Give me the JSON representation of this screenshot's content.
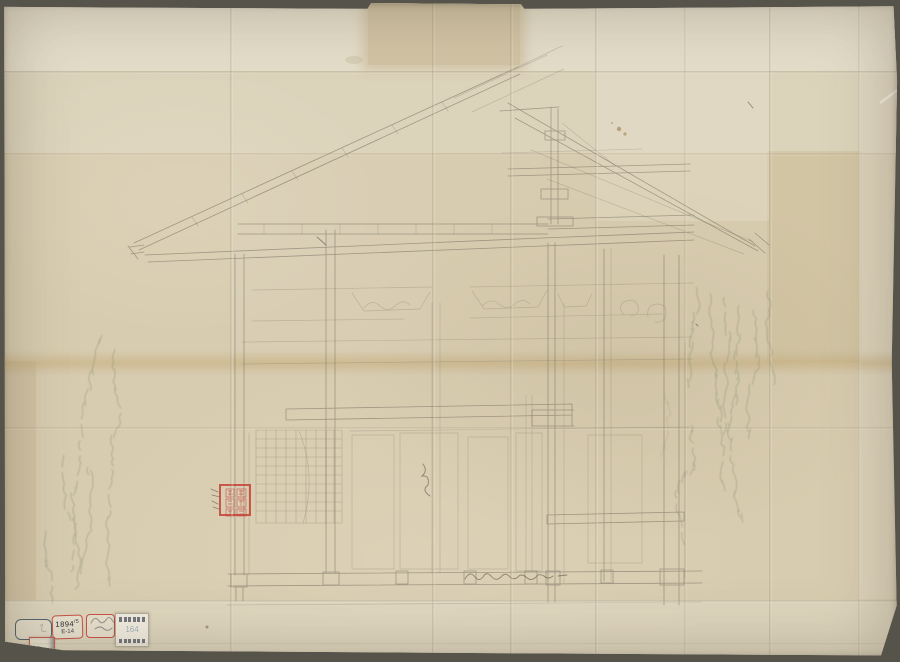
{
  "page": {
    "kind": "scanned-architectural-drawing",
    "subject": "temple-roof-section-pencil-draft"
  },
  "colors": {
    "backdrop": "#56534b",
    "paper": "#d8ccb0",
    "paper_light": "#e4ddc9",
    "fold_shadow": "#6c5d40",
    "pencil": "#6f6a5c",
    "ghost_ink": "#72806a",
    "stamp_red": "#c43a2e",
    "ink_dark": "#23232e",
    "label_bg": "#f1ede0",
    "label_center_blue": "#6d83a8",
    "frame_stamp_blue": "#54656f"
  },
  "stamps": {
    "s1": {
      "note": "rounded rectangular frame stamp, mostly empty",
      "hook": "ろ"
    },
    "s2": {
      "line1": "1894",
      "sup": "/5",
      "line2": "E-14"
    },
    "s3": {
      "note": "red-framed stamp with illegible cursive ink inscription"
    },
    "s4": {
      "center": "164",
      "note": "white archive label with rows of tiny printed characters"
    },
    "s5": {
      "text": "45-",
      "note": "small red-framed stamp, right edge smudged dark"
    },
    "seal": {
      "note": "square red collection seal, six illegible glyphs in two columns"
    }
  },
  "marks": {
    "bottom_signature": "illegible cursive pencil inscription",
    "ghost_writing": "ink bleed-through calligraphy columns (left and right margins)",
    "ledger_column": "small faint vertical character list beside right post"
  }
}
